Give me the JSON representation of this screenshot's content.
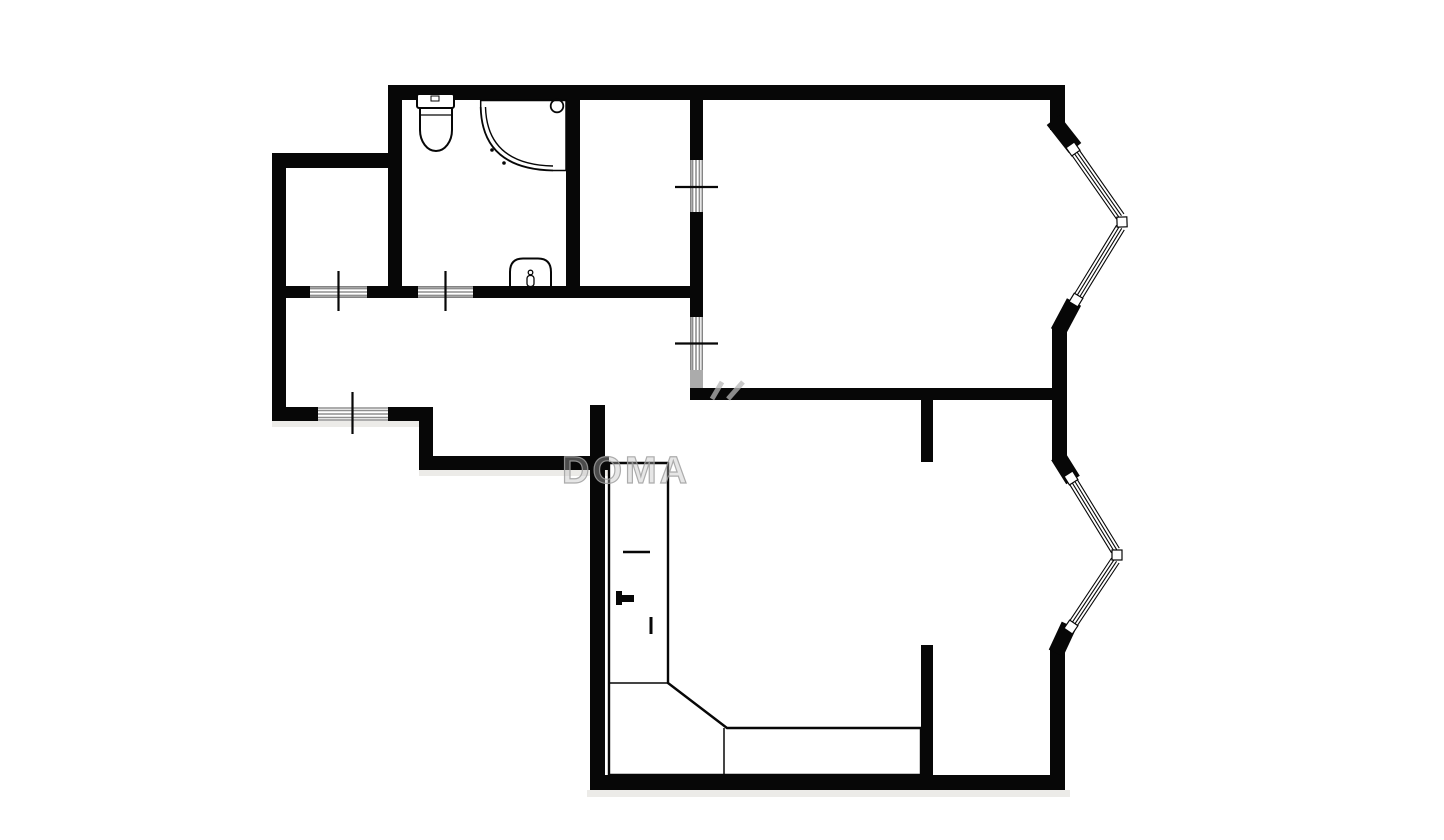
{
  "watermark": {
    "text": "DOMA"
  },
  "colors": {
    "background": "#ffffff",
    "wall": "#070707",
    "hatch": "#8f8f8f",
    "hatch_dark": "#5a5a5a",
    "watermark": "#b8b8b8",
    "shadow": "#ecebe8"
  },
  "fixtures": {
    "toilet": "toilet-icon",
    "shower": "shower-cabin-icon",
    "sink": "washbasin-icon",
    "counter": "kitchen-counter",
    "counter_tap": "tap-icon"
  },
  "openings": {
    "door_style": "hatched-opening-with-tick",
    "door_count": 5,
    "bay_window_count": 2
  }
}
